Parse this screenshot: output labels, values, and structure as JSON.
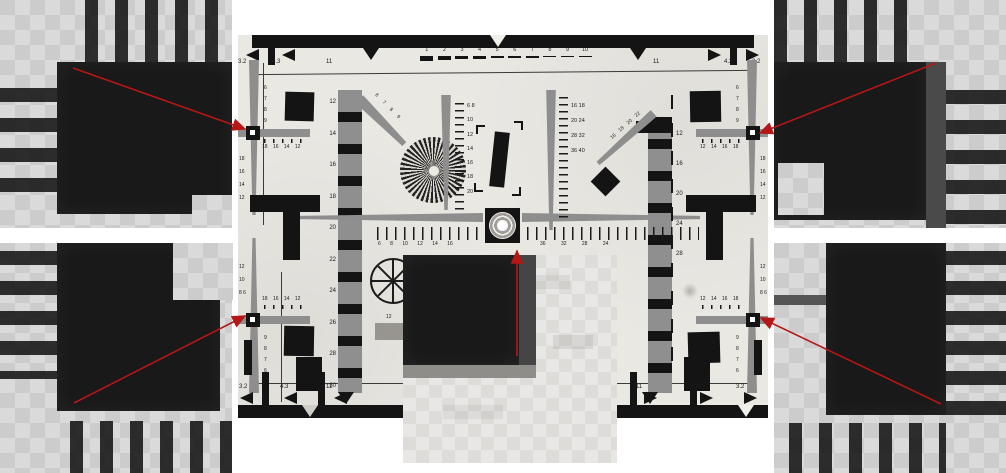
{
  "colors": {
    "page_bg": "#ffffff",
    "paper": "#eae8e3",
    "ink": "#141414",
    "gray": "#8e8e8e",
    "inset_light_a": "#dadada",
    "inset_light_b": "#cccccc",
    "inset_dark": "#191919",
    "arrow": "#b51616"
  },
  "chart": {
    "labels": {
      "top_scale": [
        "1",
        "2",
        "3",
        "4",
        "5",
        "6",
        "7",
        "8",
        "9",
        "10"
      ],
      "frame_top_left": [
        "3.2",
        "4.3",
        "11"
      ],
      "frame_top_right": [
        "11",
        "4.3",
        "3.2"
      ],
      "frame_bottom_left": [
        "3.2",
        "4.3",
        "11"
      ],
      "frame_bottom_right": [
        "11",
        "4.3",
        "3.2"
      ],
      "left_column": "12 14 16 18 20 22 24 26 28 30",
      "right_column": "12 16 20 24 28",
      "center_vertical_scale": "6 8 10 12 14 16 18 20",
      "right_vertical_scale": "16 18 20 24 28 32 36 40",
      "horizontal_scale_left": "6 8 10 12 14 16",
      "horizontal_scale_right": "36 32 28 24",
      "diagonal_top_left": "6 7 8 9",
      "diagonal_top_right": "16 18 20 22",
      "wheel_number": "12",
      "cross_vertical_top": "6 7 8 9",
      "cross_vertical_bottom": "9 8 7 6",
      "cross_horizontal_left": "18 16 14 12",
      "cross_horizontal_right": "12 14 16 18",
      "cross_side_top": "18 16 14 12",
      "cross_side_bottom": "12 10 8 6"
    }
  }
}
